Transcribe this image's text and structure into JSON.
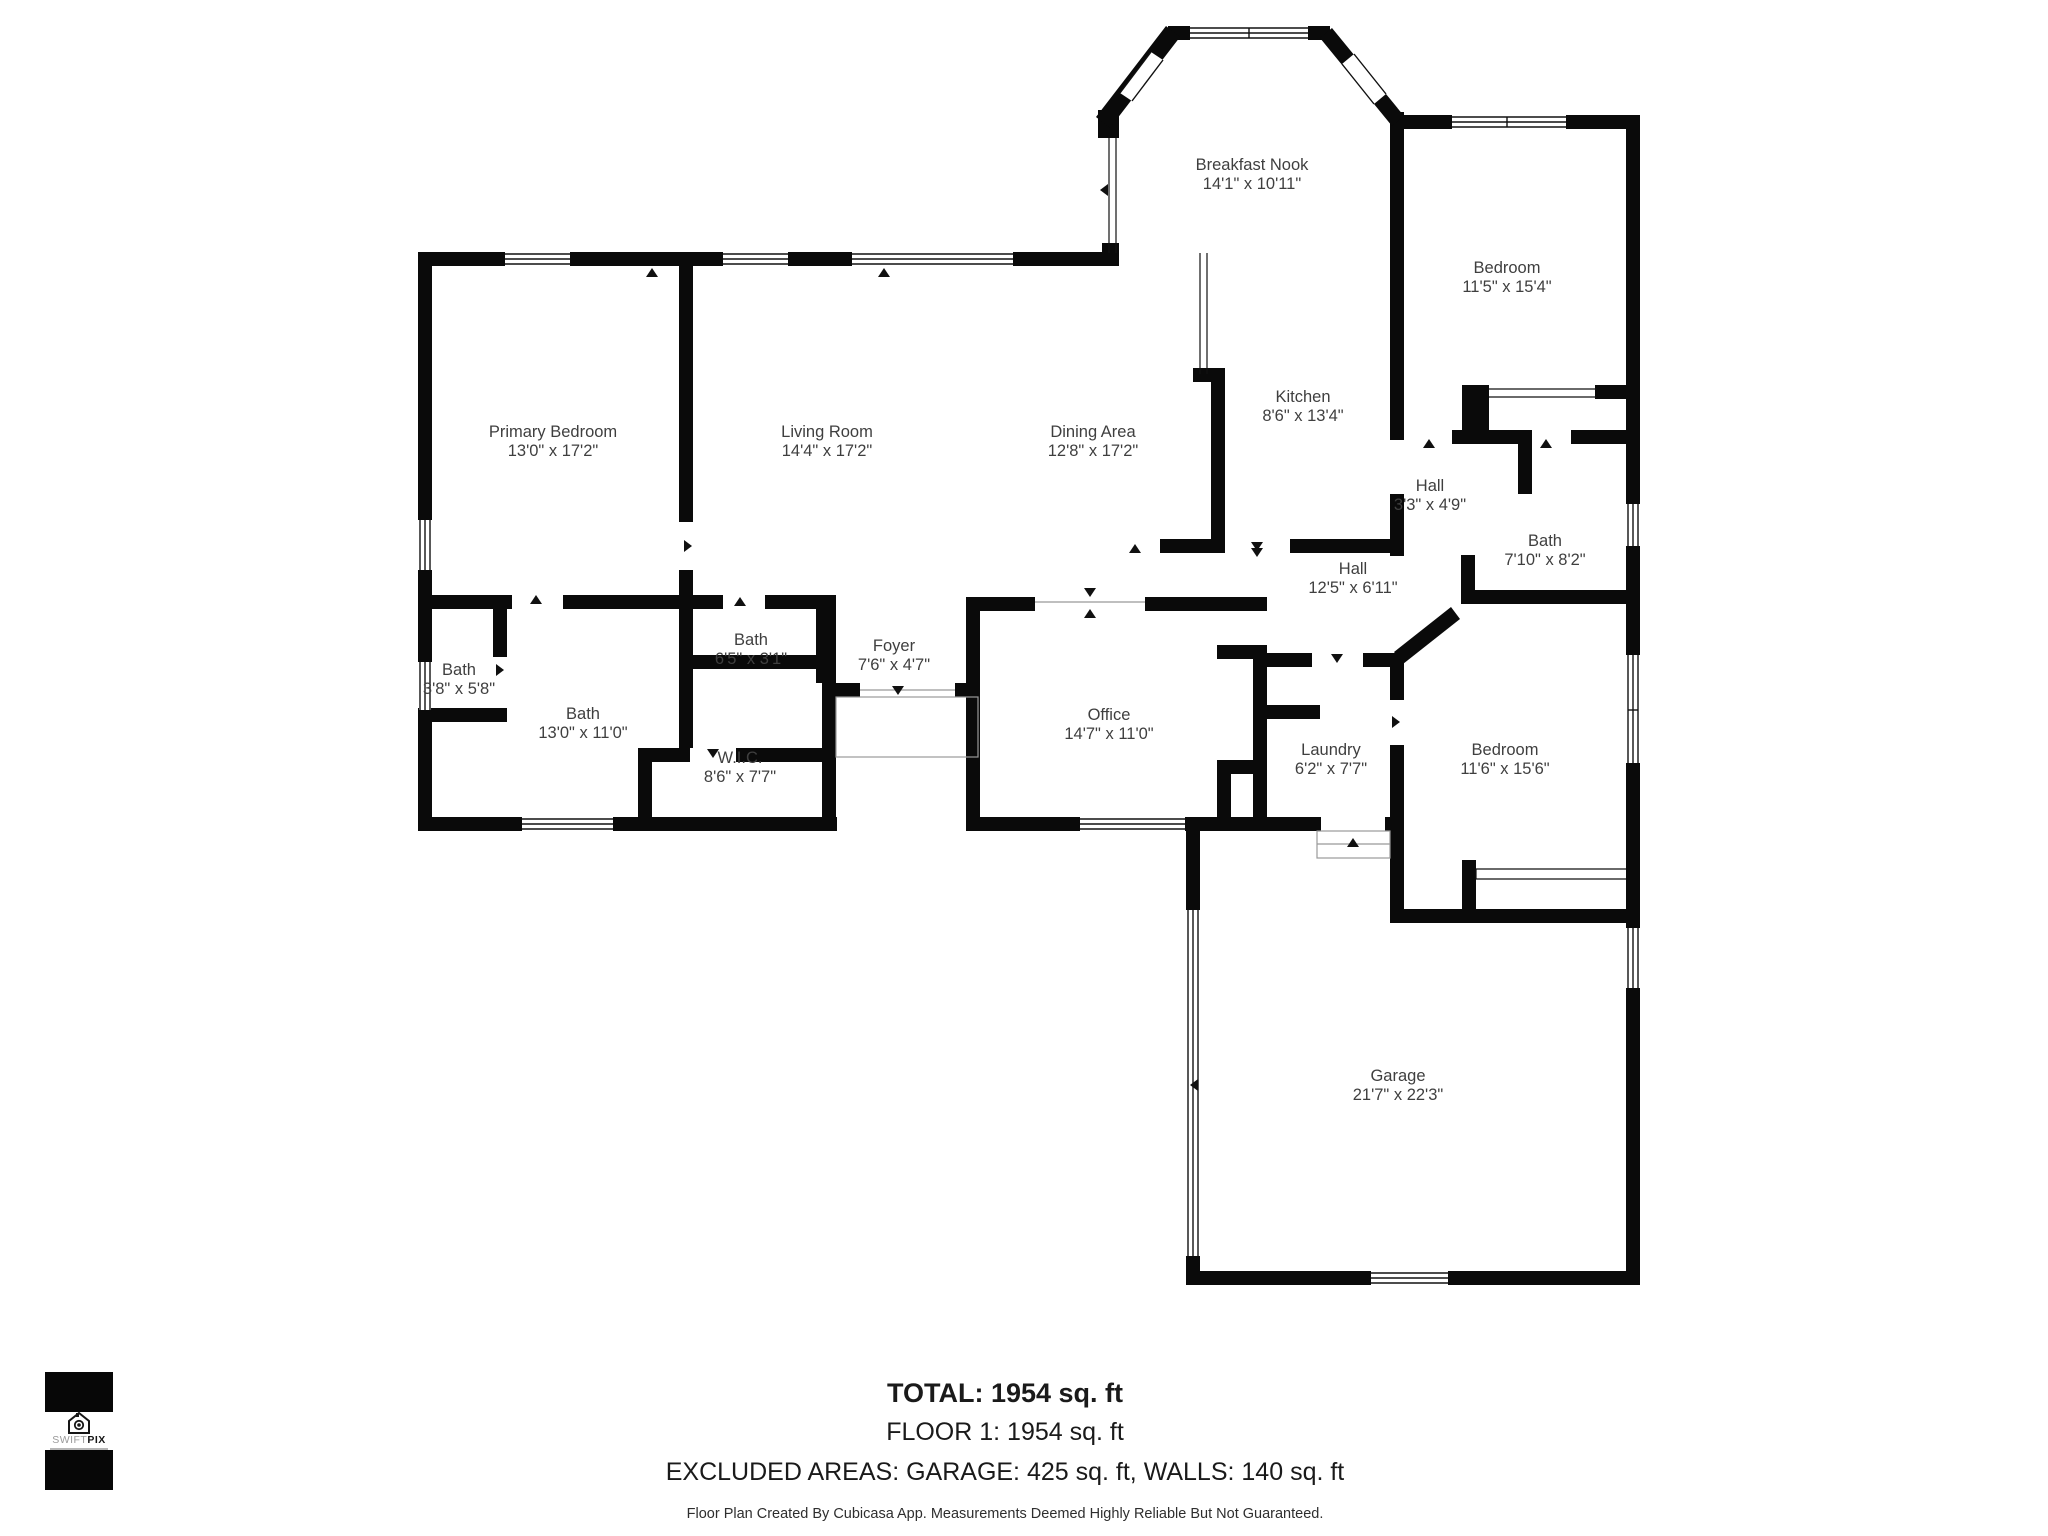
{
  "floor_plan": {
    "rooms": [
      {
        "name": "Breakfast Nook",
        "dims": "14'1\" x 10'11\"",
        "x": 1252,
        "y": 170
      },
      {
        "name": "Bedroom",
        "dims": "11'5\" x 15'4\"",
        "x": 1507,
        "y": 273
      },
      {
        "name": "Kitchen",
        "dims": "8'6\" x 13'4\"",
        "x": 1303,
        "y": 402
      },
      {
        "name": "Primary Bedroom",
        "dims": "13'0\" x 17'2\"",
        "x": 553,
        "y": 437
      },
      {
        "name": "Living Room",
        "dims": "14'4\" x 17'2\"",
        "x": 827,
        "y": 437
      },
      {
        "name": "Dining Area",
        "dims": "12'8\" x 17'2\"",
        "x": 1093,
        "y": 437
      },
      {
        "name": "Hall",
        "dims": "3'3\" x 4'9\"",
        "x": 1430,
        "y": 491
      },
      {
        "name": "Bath",
        "dims": "7'10\" x 8'2\"",
        "x": 1545,
        "y": 546
      },
      {
        "name": "Hall",
        "dims": "12'5\" x 6'11\"",
        "x": 1353,
        "y": 574
      },
      {
        "name": "Bath",
        "dims": "3'8\" x 5'8\"",
        "x": 459,
        "y": 675
      },
      {
        "name": "Bath",
        "dims": "6'5\" x 3'1\"",
        "x": 751,
        "y": 645
      },
      {
        "name": "Bath",
        "dims": "13'0\" x 11'0\"",
        "x": 583,
        "y": 719
      },
      {
        "name": "Foyer",
        "dims": "7'6\" x 4'7\"",
        "x": 894,
        "y": 651
      },
      {
        "name": "W.I.C.",
        "dims": "8'6\" x 7'7\"",
        "x": 740,
        "y": 763
      },
      {
        "name": "Office",
        "dims": "14'7\" x 11'0\"",
        "x": 1109,
        "y": 720
      },
      {
        "name": "Laundry",
        "dims": "6'2\" x 7'7\"",
        "x": 1331,
        "y": 755
      },
      {
        "name": "Bedroom",
        "dims": "11'6\" x 15'6\"",
        "x": 1505,
        "y": 755
      },
      {
        "name": "Garage",
        "dims": "21'7\" x 22'3\"",
        "x": 1398,
        "y": 1081
      }
    ]
  },
  "footer": {
    "total": "TOTAL: 1954 sq. ft",
    "floor": "FLOOR 1: 1954 sq. ft",
    "excluded": "EXCLUDED AREAS: GARAGE: 425 sq. ft, WALLS: 140 sq. ft",
    "disclaimer": "Floor Plan Created By Cubicasa App. Measurements Deemed Highly Reliable But Not Guaranteed."
  },
  "logo": {
    "brand_light": "SWIFT",
    "brand_bold": "PIX"
  }
}
